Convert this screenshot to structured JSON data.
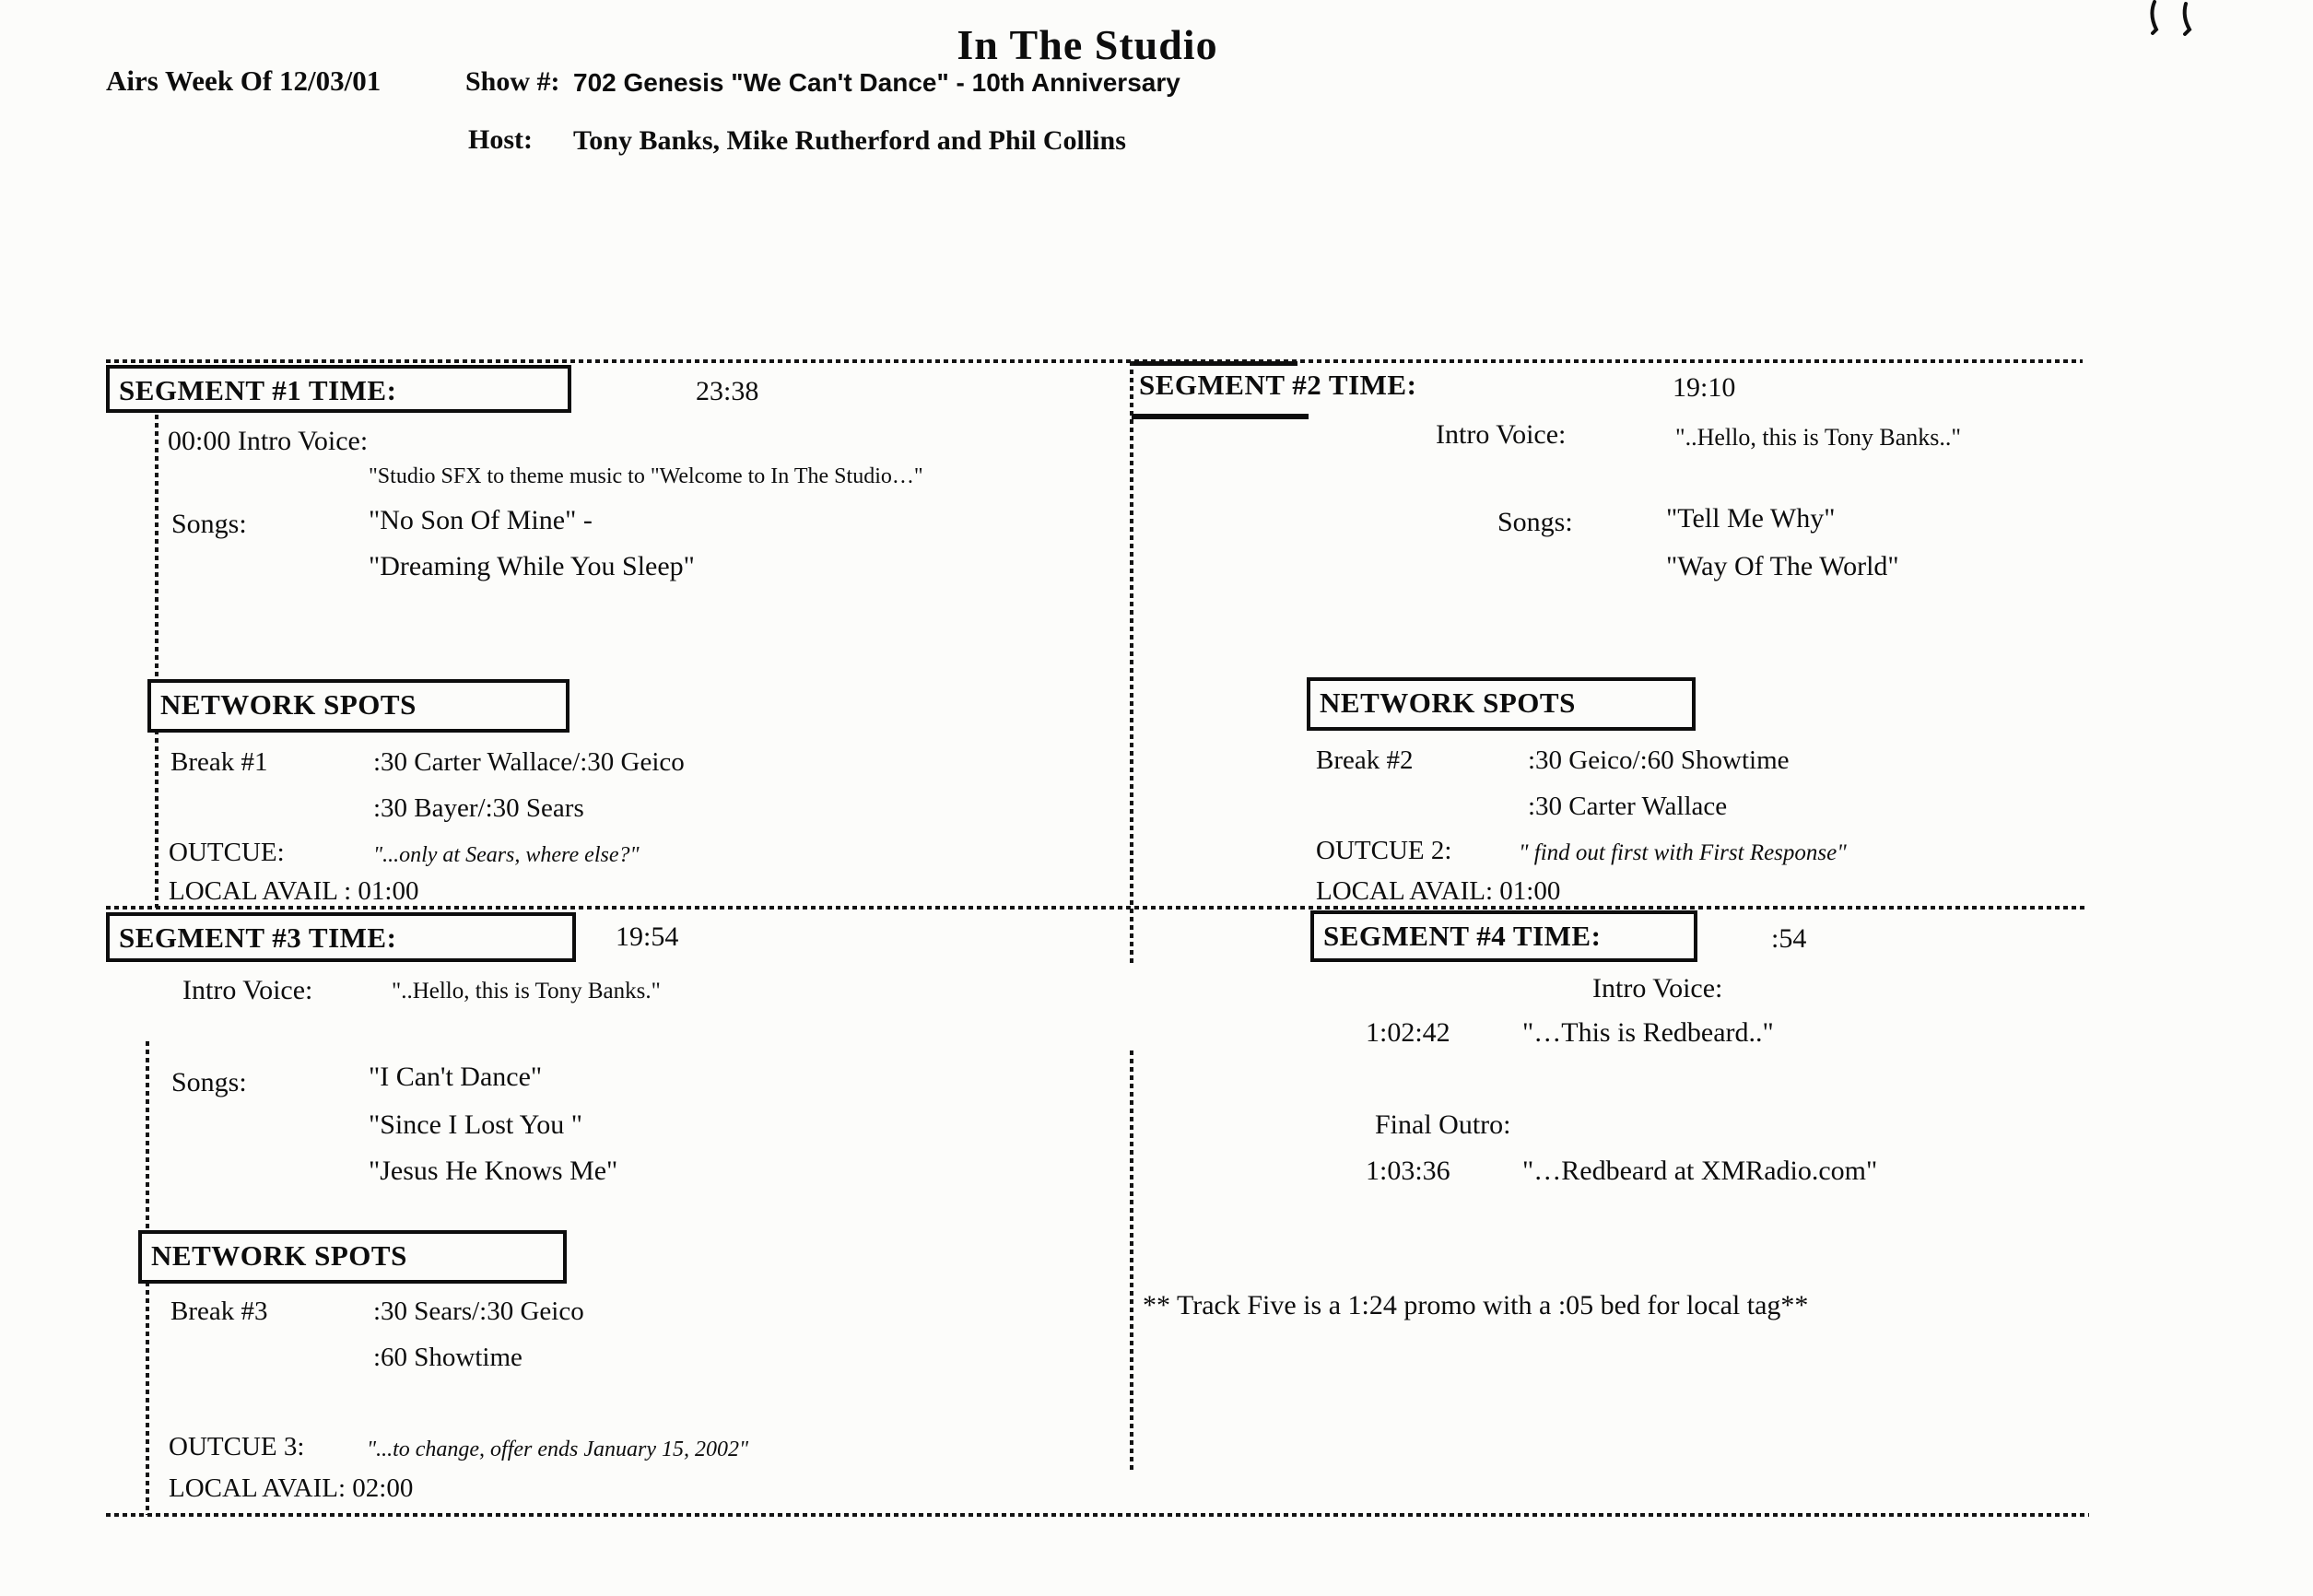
{
  "header": {
    "title": "In The Studio",
    "airs": "Airs Week Of  12/03/01",
    "show_label": "Show #:",
    "show_value": "702  Genesis \"We Can't Dance\" - 10th Anniversary",
    "host_label": "Host:",
    "host_value": "Tony Banks, Mike Rutherford and Phil Collins"
  },
  "seg1": {
    "header": "SEGMENT #1 TIME:",
    "time": "23:38",
    "intro_line": "00:00  Intro Voice:",
    "intro_quote": "\"Studio SFX to theme music to \"Welcome to In The Studio…\"",
    "songs_label": "Songs:",
    "song1": "\"No Son Of Mine\" -",
    "song2": "\"Dreaming While You Sleep\""
  },
  "seg2": {
    "header": "SEGMENT #2 TIME:",
    "time": "19:10",
    "intro_label": "Intro Voice:",
    "intro_quote": "\"..Hello, this is Tony Banks..\"",
    "songs_label": "Songs:",
    "song1": "\"Tell Me Why\"",
    "song2": "\"Way Of The World\""
  },
  "spots1": {
    "header": "NETWORK SPOTS",
    "break_label": "Break #1",
    "line1": ":30 Carter Wallace/:30 Geico",
    "line2": ":30 Bayer/:30 Sears",
    "outcue_label": "OUTCUE:",
    "outcue_quote": "\"...only at Sears, where else?\"",
    "local_avail": "LOCAL AVAIL :  01:00"
  },
  "spots2": {
    "header": "NETWORK SPOTS",
    "break_label": "Break #2",
    "line1": ":30 Geico/:60 Showtime",
    "line2": ":30 Carter Wallace",
    "outcue_label": "OUTCUE 2:",
    "outcue_quote": "\" find out first with First Response\"",
    "local_avail": "LOCAL AVAIL:  01:00"
  },
  "seg3": {
    "header": "SEGMENT #3 TIME:",
    "time": "19:54",
    "intro_label": "Intro Voice:",
    "intro_quote": "\"..Hello, this is Tony Banks.\"",
    "songs_label": "Songs:",
    "song1": "\"I Can't Dance\"",
    "song2": "\"Since I Lost You \"",
    "song3": "\"Jesus He Knows Me\""
  },
  "seg4": {
    "header": "SEGMENT #4 TIME:",
    "time": ":54",
    "intro_label": "Intro Voice:",
    "intro_time": "1:02:42",
    "intro_quote": "\"…This is Redbeard..\"",
    "outro_label": "Final Outro:",
    "outro_time": "1:03:36",
    "outro_quote": "\"…Redbeard at XMRadio.com\""
  },
  "spots3": {
    "header": "NETWORK SPOTS",
    "break_label": "Break #3",
    "line1": ":30 Sears/:30 Geico",
    "line2": ":60 Showtime",
    "outcue_label": "OUTCUE 3:",
    "outcue_quote": "\"...to change, offer ends January 15, 2002\"",
    "local_avail": "LOCAL AVAIL: 02:00"
  },
  "note": "** Track Five is a  1:24  promo with a :05 bed for local tag**"
}
